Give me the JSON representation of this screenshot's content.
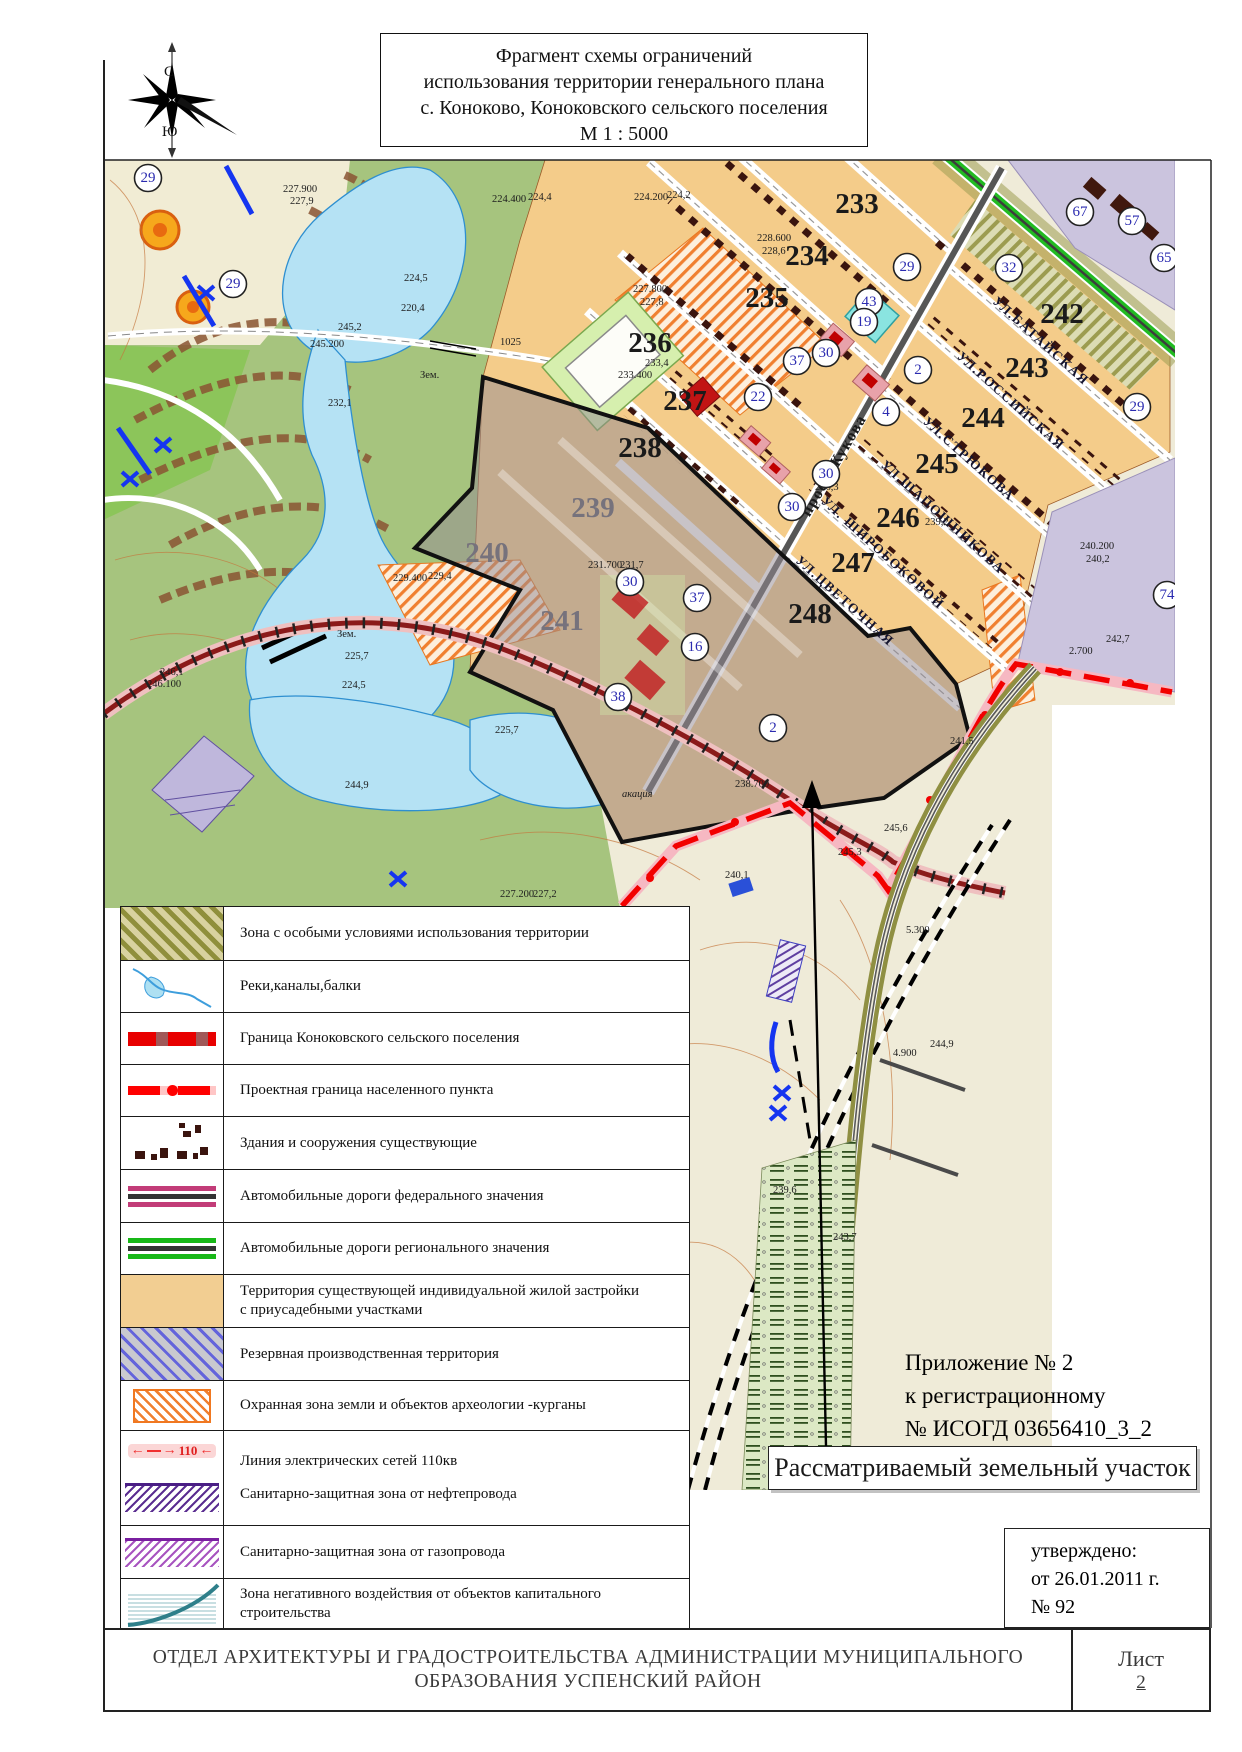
{
  "title": {
    "line1": "Фрагмент схемы ограничений",
    "line2": "использования территории генерального плана",
    "line3": "с. Коноково, Коноковского сельского поселения",
    "line4": "М 1 : 5000"
  },
  "compass": {
    "north": "С",
    "south": "Ю"
  },
  "map": {
    "blocks": [
      {
        "n": "233",
        "x": 857,
        "y": 213,
        "cls": "blk"
      },
      {
        "n": "234",
        "x": 807,
        "y": 265,
        "cls": "blk"
      },
      {
        "n": "235",
        "x": 767,
        "y": 307,
        "cls": "blk"
      },
      {
        "n": "236",
        "x": 650,
        "y": 352,
        "cls": "blk"
      },
      {
        "n": "237",
        "x": 685,
        "y": 410,
        "cls": "blk"
      },
      {
        "n": "238",
        "x": 640,
        "y": 457,
        "cls": "blk"
      },
      {
        "n": "239",
        "x": 593,
        "y": 517,
        "cls": "blk blk-muted"
      },
      {
        "n": "240",
        "x": 487,
        "y": 562,
        "cls": "blk blk-muted"
      },
      {
        "n": "241",
        "x": 562,
        "y": 630,
        "cls": "blk blk-muted"
      },
      {
        "n": "242",
        "x": 1062,
        "y": 323,
        "cls": "blk"
      },
      {
        "n": "243",
        "x": 1027,
        "y": 377,
        "cls": "blk"
      },
      {
        "n": "244",
        "x": 983,
        "y": 427,
        "cls": "blk"
      },
      {
        "n": "245",
        "x": 937,
        "y": 473,
        "cls": "blk"
      },
      {
        "n": "246",
        "x": 898,
        "y": 527,
        "cls": "blk"
      },
      {
        "n": "247",
        "x": 853,
        "y": 572,
        "cls": "blk"
      },
      {
        "n": "248",
        "x": 810,
        "y": 623,
        "cls": "blk"
      }
    ],
    "circles": [
      {
        "n": "29",
        "x": 148,
        "y": 178
      },
      {
        "n": "29",
        "x": 233,
        "y": 284
      },
      {
        "n": "29",
        "x": 907,
        "y": 267
      },
      {
        "n": "32",
        "x": 1009,
        "y": 268
      },
      {
        "n": "43",
        "x": 869,
        "y": 302
      },
      {
        "n": "19",
        "x": 864,
        "y": 322
      },
      {
        "n": "30",
        "x": 826,
        "y": 353
      },
      {
        "n": "37",
        "x": 797,
        "y": 361
      },
      {
        "n": "2",
        "x": 918,
        "y": 370
      },
      {
        "n": "22",
        "x": 758,
        "y": 397
      },
      {
        "n": "4",
        "x": 886,
        "y": 412
      },
      {
        "n": "30",
        "x": 826,
        "y": 474
      },
      {
        "n": "30",
        "x": 792,
        "y": 507
      },
      {
        "n": "30",
        "x": 630,
        "y": 582
      },
      {
        "n": "37",
        "x": 697,
        "y": 598
      },
      {
        "n": "16",
        "x": 695,
        "y": 647
      },
      {
        "n": "38",
        "x": 618,
        "y": 697
      },
      {
        "n": "2",
        "x": 773,
        "y": 728
      },
      {
        "n": "67",
        "x": 1080,
        "y": 212
      },
      {
        "n": "57",
        "x": 1132,
        "y": 221
      },
      {
        "n": "65",
        "x": 1164,
        "y": 258
      },
      {
        "n": "29",
        "x": 1137,
        "y": 407
      },
      {
        "n": "74",
        "x": 1167,
        "y": 595
      }
    ],
    "streets": [
      {
        "name": "просп.Жукова",
        "x": 838,
        "y": 468,
        "tr": "rotate(-60 838 468)",
        "cls": "street zhukova"
      },
      {
        "name": "УЛ.БАТАЙСКАЯ",
        "x": 1038,
        "y": 344,
        "tr": "rotate(42 1038 344)",
        "cls": "street"
      },
      {
        "name": "УЛ.РОССИЙСКАЯ",
        "x": 1008,
        "y": 404,
        "tr": "rotate(42 1008 404)",
        "cls": "street"
      },
      {
        "name": "УЛ.СТРЮКОВА",
        "x": 966,
        "y": 462,
        "tr": "rotate(42 966 462)",
        "cls": "street"
      },
      {
        "name": "УЛ.ШАПОШНИКОВА",
        "x": 940,
        "y": 520,
        "tr": "rotate(42 940 520)",
        "cls": "street"
      },
      {
        "name": "УЛ. ШИРОБОКОВОЙ",
        "x": 880,
        "y": 556,
        "tr": "rotate(42 880 556)",
        "cls": "street"
      },
      {
        "name": "УЛ.ЦВЕТОЧНАЯ",
        "x": 842,
        "y": 604,
        "tr": "rotate(42 842 604)",
        "cls": "street"
      }
    ],
    "elevations": [
      {
        "t": "227.900",
        "x": 283,
        "y": 192,
        "cls": "elev"
      },
      {
        "t": "227,9",
        "x": 290,
        "y": 204,
        "cls": "elev"
      },
      {
        "t": "224.400",
        "x": 492,
        "y": 202,
        "cls": "elev"
      },
      {
        "t": "224,4",
        "x": 528,
        "y": 200,
        "cls": "elev"
      },
      {
        "t": "224.200",
        "x": 634,
        "y": 200,
        "cls": "elev"
      },
      {
        "t": "224,2",
        "x": 667,
        "y": 198,
        "cls": "elev"
      },
      {
        "t": "227.800",
        "x": 633,
        "y": 292,
        "cls": "elev"
      },
      {
        "t": "227,8",
        "x": 640,
        "y": 305,
        "cls": "elev"
      },
      {
        "t": "228.600",
        "x": 757,
        "y": 241,
        "cls": "elev"
      },
      {
        "t": "228,6",
        "x": 762,
        "y": 254,
        "cls": "elev"
      },
      {
        "t": "245,2",
        "x": 338,
        "y": 330,
        "cls": "elev"
      },
      {
        "t": "245.200",
        "x": 310,
        "y": 347,
        "cls": "elev"
      },
      {
        "t": "224,5",
        "x": 404,
        "y": 281,
        "cls": "elev"
      },
      {
        "t": "220,4",
        "x": 401,
        "y": 311,
        "cls": "elev"
      },
      {
        "t": "232,1",
        "x": 328,
        "y": 406,
        "cls": "elev"
      },
      {
        "t": "Зем.",
        "x": 420,
        "y": 378,
        "cls": "elev"
      },
      {
        "t": "Зем.",
        "x": 337,
        "y": 637,
        "cls": "elev"
      },
      {
        "t": "1025",
        "x": 500,
        "y": 345,
        "cls": "elev"
      },
      {
        "t": "233.400",
        "x": 618,
        "y": 378,
        "cls": "elev"
      },
      {
        "t": "233,4",
        "x": 645,
        "y": 366,
        "cls": "elev"
      },
      {
        "t": "229.400",
        "x": 393,
        "y": 581,
        "cls": "elev"
      },
      {
        "t": "229,4",
        "x": 428,
        "y": 579,
        "cls": "elev"
      },
      {
        "t": "231.700",
        "x": 588,
        "y": 568,
        "cls": "elev"
      },
      {
        "t": "231,7",
        "x": 620,
        "y": 568,
        "cls": "elev"
      },
      {
        "t": "225,7",
        "x": 345,
        "y": 659,
        "cls": "elev"
      },
      {
        "t": "224,5",
        "x": 342,
        "y": 688,
        "cls": "elev"
      },
      {
        "t": "246,1",
        "x": 160,
        "y": 675,
        "cls": "elev"
      },
      {
        "t": "246.100",
        "x": 147,
        "y": 687,
        "cls": "elev"
      },
      {
        "t": "225,7",
        "x": 495,
        "y": 733,
        "cls": "elev"
      },
      {
        "t": "244,9",
        "x": 345,
        "y": 788,
        "cls": "elev"
      },
      {
        "t": "227.200",
        "x": 500,
        "y": 897,
        "cls": "elev"
      },
      {
        "t": "227,2",
        "x": 533,
        "y": 897,
        "cls": "elev"
      },
      {
        "t": "акация",
        "x": 622,
        "y": 797,
        "cls": "elev ital"
      },
      {
        "t": "238.700",
        "x": 735,
        "y": 787,
        "cls": "elev"
      },
      {
        "t": "245,6",
        "x": 884,
        "y": 831,
        "cls": "elev"
      },
      {
        "t": "240,1",
        "x": 725,
        "y": 878,
        "cls": "elev"
      },
      {
        "t": "241,5",
        "x": 950,
        "y": 744,
        "cls": "elev"
      },
      {
        "t": "245,3",
        "x": 838,
        "y": 855,
        "cls": "elev"
      },
      {
        "t": "5.300",
        "x": 906,
        "y": 933,
        "cls": "elev"
      },
      {
        "t": "244,9",
        "x": 930,
        "y": 1047,
        "cls": "elev"
      },
      {
        "t": "4.900",
        "x": 893,
        "y": 1056,
        "cls": "elev"
      },
      {
        "t": "239,6",
        "x": 773,
        "y": 1193,
        "cls": "elev"
      },
      {
        "t": "243,7",
        "x": 833,
        "y": 1240,
        "cls": "elev"
      },
      {
        "t": "240.200",
        "x": 1080,
        "y": 549,
        "cls": "elev"
      },
      {
        "t": "240,2",
        "x": 1086,
        "y": 562,
        "cls": "elev"
      },
      {
        "t": "242,7",
        "x": 1106,
        "y": 642,
        "cls": "elev"
      },
      {
        "t": "2.700",
        "x": 1069,
        "y": 654,
        "cls": "elev"
      },
      {
        "t": "236,3",
        "x": 815,
        "y": 490,
        "cls": "elev"
      },
      {
        "t": "239,2",
        "x": 925,
        "y": 525,
        "cls": "elev"
      }
    ]
  },
  "legend": {
    "rows": [
      {
        "label": "Зона с особыми условиями использования территории"
      },
      {
        "label": "Реки,каналы,балки"
      },
      {
        "label": "Граница Коноковского сельского поселения"
      },
      {
        "label": "Проектная граница населенного пункта"
      },
      {
        "label": "Здания и сооружения существующие"
      },
      {
        "label": "Автомобильные дороги федерального значения"
      },
      {
        "label": "Автомобильные дороги регионального значения"
      },
      {
        "label": "Территория существующей индивидуальной  жилой застройки",
        "label2": "с приусадебными участками"
      },
      {
        "label": "Резервная производственная территория"
      },
      {
        "label": "Охранная зона земли и объектов археологии -курганы"
      },
      {
        "label": "Линия электрических сетей 110кв",
        "label2": "Санитарно-защитная зона от нефтепровода",
        "value": "110"
      },
      {
        "label": "Санитарно-защитная зона от газопровода"
      },
      {
        "label": "Зона негативного воздействия от объектов капитального строительства"
      }
    ]
  },
  "annotations": {
    "prilozhenie": [
      "Приложение № 2",
      "к регистрационному",
      "№ ИСОГД 03656410_3_2"
    ],
    "parcel_label": "Рассматриваемый земельный участок",
    "approved": [
      "утверждено:",
      "от 26.01.2011 г.",
      "№ 92"
    ]
  },
  "footer": {
    "org_line1": "ОТДЕЛ АРХИТЕКТУРЫ И ГРАДОСТРОИТЕЛЬСТВА АДМИНИСТРАЦИИ МУНИЦИПАЛЬНОГО",
    "org_line2": "ОБРАЗОВАНИЯ УСПЕНСКИЙ РАЙОН",
    "sheet_label": "Лист",
    "sheet_number": "2"
  },
  "colors": {
    "water": "#B5E2F4",
    "residential": "#F4CC8A",
    "terrain": "#A6C47E",
    "parcel_fill": "#9E929880",
    "project_boundary": "#F20000",
    "settlement_boundary": "#8B1A1A",
    "regional_road": "#18B818",
    "federal_road": "#C23C78",
    "archaeology": "#F08030",
    "reserve": "#CBC4DE"
  }
}
